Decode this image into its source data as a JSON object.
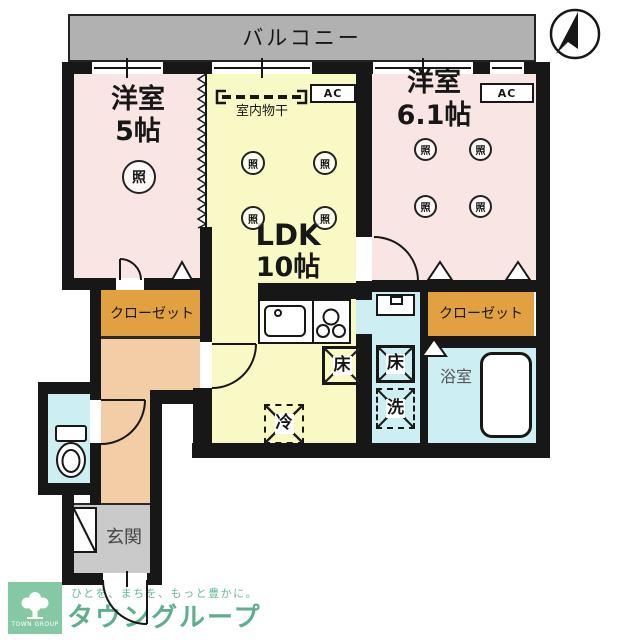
{
  "balcony": {
    "label": "バルコニー"
  },
  "rooms": {
    "western1": {
      "name": "洋室",
      "size": "5帖"
    },
    "western2": {
      "name": "洋室",
      "size": "6.1帖"
    },
    "ldk": {
      "name": "LDK",
      "size": "10帖"
    },
    "bathroom": {
      "label": "浴室"
    },
    "entrance": {
      "label": "玄関"
    },
    "closet1": {
      "label": "クローゼット"
    },
    "closet2": {
      "label": "クローゼット"
    }
  },
  "fixtures": {
    "ac": "AC",
    "indoor_drying": "室内物干",
    "light": "照",
    "floor_storage": "床",
    "refrigerator": "冷",
    "washer": "洗"
  },
  "logo": {
    "org": "TOWN GROUP",
    "tagline": "ひとを、まちを、もっと豊かに。",
    "brand": "タウングループ"
  },
  "colors": {
    "wall": "#171717",
    "room_pink": "#f9e5e3",
    "ldk_yellow": "#f9f9c6",
    "closet_orange": "#e2a140",
    "hall_peach": "#f3cda6",
    "wet_blue": "#cdeef2",
    "balcony_gray": "#b1b1b1",
    "entrance_gray": "#cacaca",
    "brand_green": "#5fae8d",
    "logo_bg_green": "#85c8a5"
  }
}
